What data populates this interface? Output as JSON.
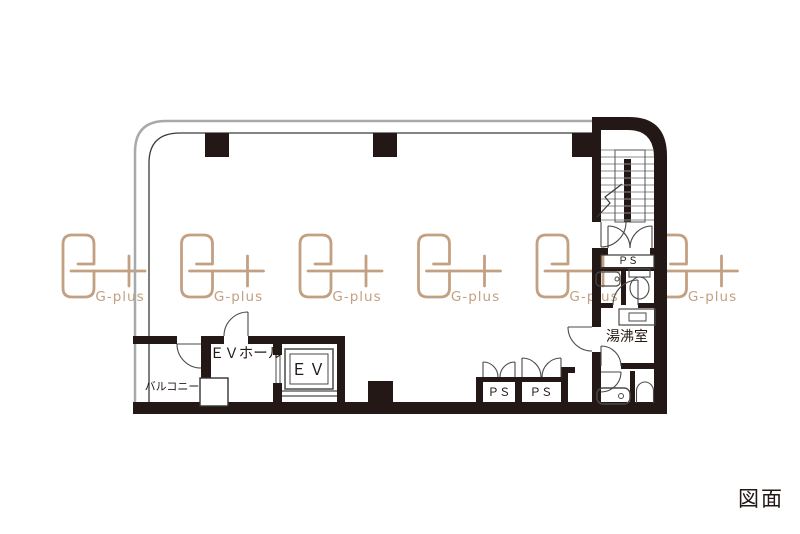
{
  "page": {
    "background": "#ffffff"
  },
  "caption": {
    "label": "図面"
  },
  "watermark": {
    "label": "G-plus",
    "color": "#c3a081"
  },
  "floorplan": {
    "labels": {
      "balcony": "バルコニー",
      "ev_hall": "ＥＶホール",
      "elevator": "ＥＶ",
      "ps_left": "ＰＳ",
      "ps_right": "ＰＳ",
      "ps_small": "ＰＳ",
      "kitchenette": "湯沸室"
    },
    "colors": {
      "wall": "#231815",
      "thin_line": "#3a3a3a",
      "door_line": "#4a4a4a",
      "gray_edge": "#a8a9a9",
      "stair_tread": "#8c8c8c",
      "watermark_tan": "#c3a081"
    }
  }
}
